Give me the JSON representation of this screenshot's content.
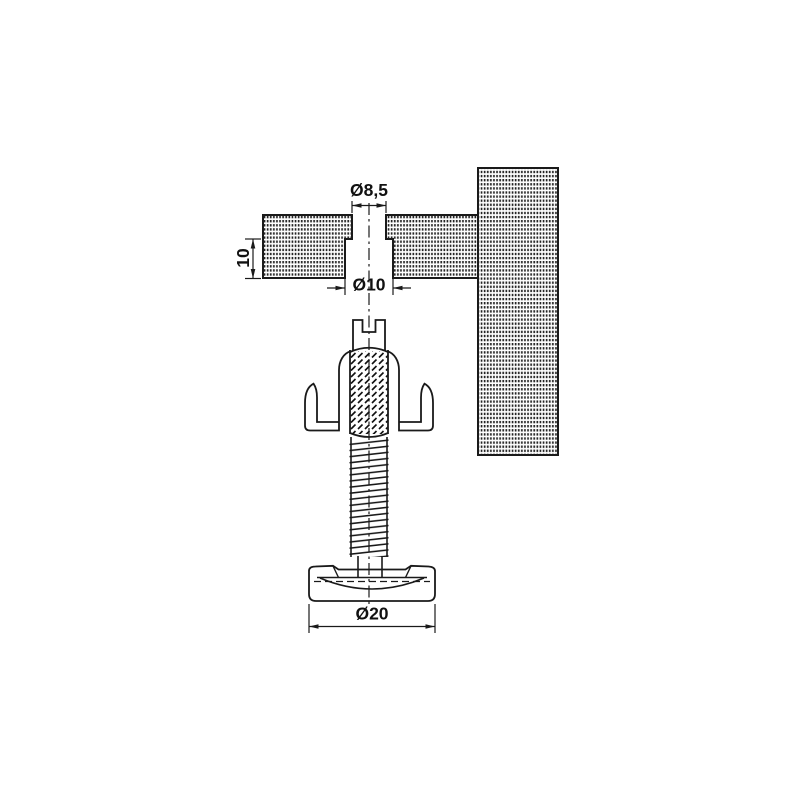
{
  "drawing": {
    "kind": "technical-drawing",
    "labels": {
      "top_hole": "Ø8,5",
      "recess_hole": "Ø10",
      "recess_depth": "10",
      "foot_diameter": "Ø20"
    },
    "colors": {
      "line": "#1a1a1a",
      "background": "#ffffff",
      "hatch_dot": "#242424"
    }
  }
}
